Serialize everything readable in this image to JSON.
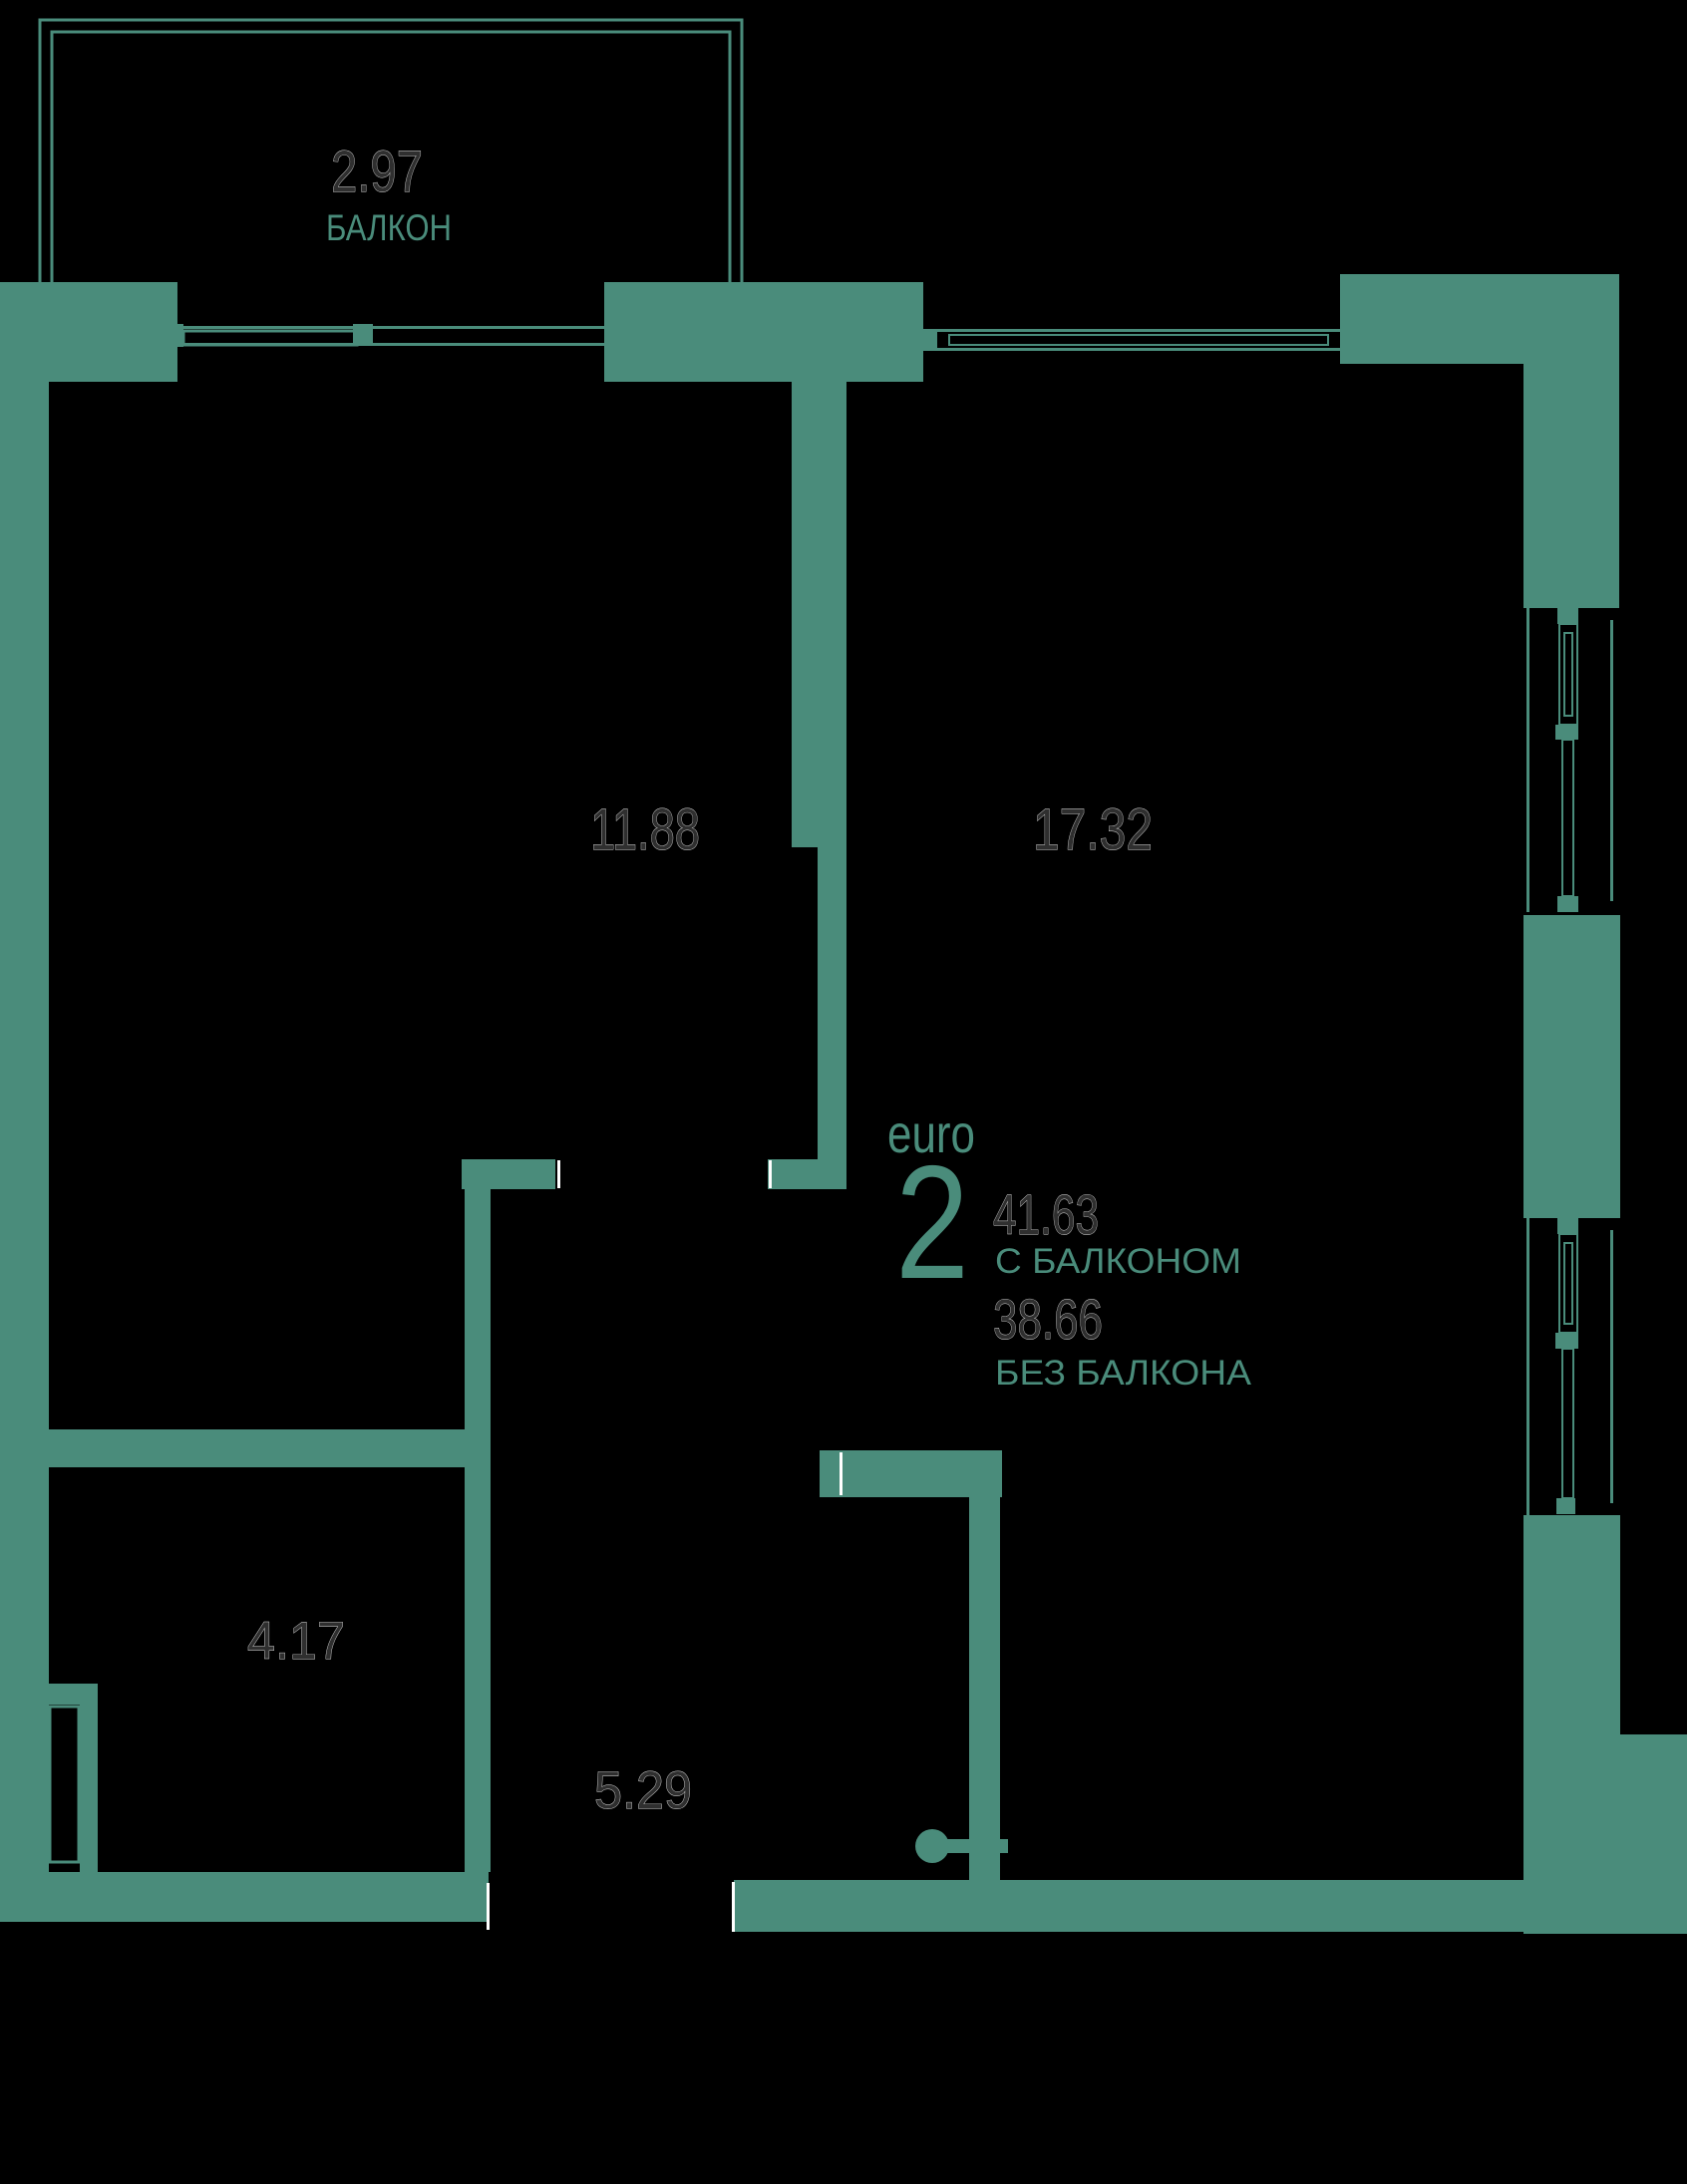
{
  "plan": {
    "colors": {
      "wall": "#4a8c7b",
      "text_dark": "#2f2f2f",
      "background": "#000000"
    },
    "unit": {
      "type_label": "euro",
      "rooms_count": "2",
      "area_with_balcony": "41.63",
      "with_balcony_label": "С БАЛКОНОМ",
      "area_without_balcony": "38.66",
      "without_balcony_label": "БЕЗ БАЛКОНА"
    },
    "rooms": [
      {
        "id": "balcony",
        "label": "БАЛКОН",
        "area": "2.97"
      },
      {
        "id": "living-room",
        "label": "",
        "area": "11.88"
      },
      {
        "id": "bedroom",
        "label": "",
        "area": "17.32"
      },
      {
        "id": "bathroom",
        "label": "",
        "area": "4.17"
      },
      {
        "id": "hallway",
        "label": "",
        "area": "5.29"
      }
    ]
  }
}
